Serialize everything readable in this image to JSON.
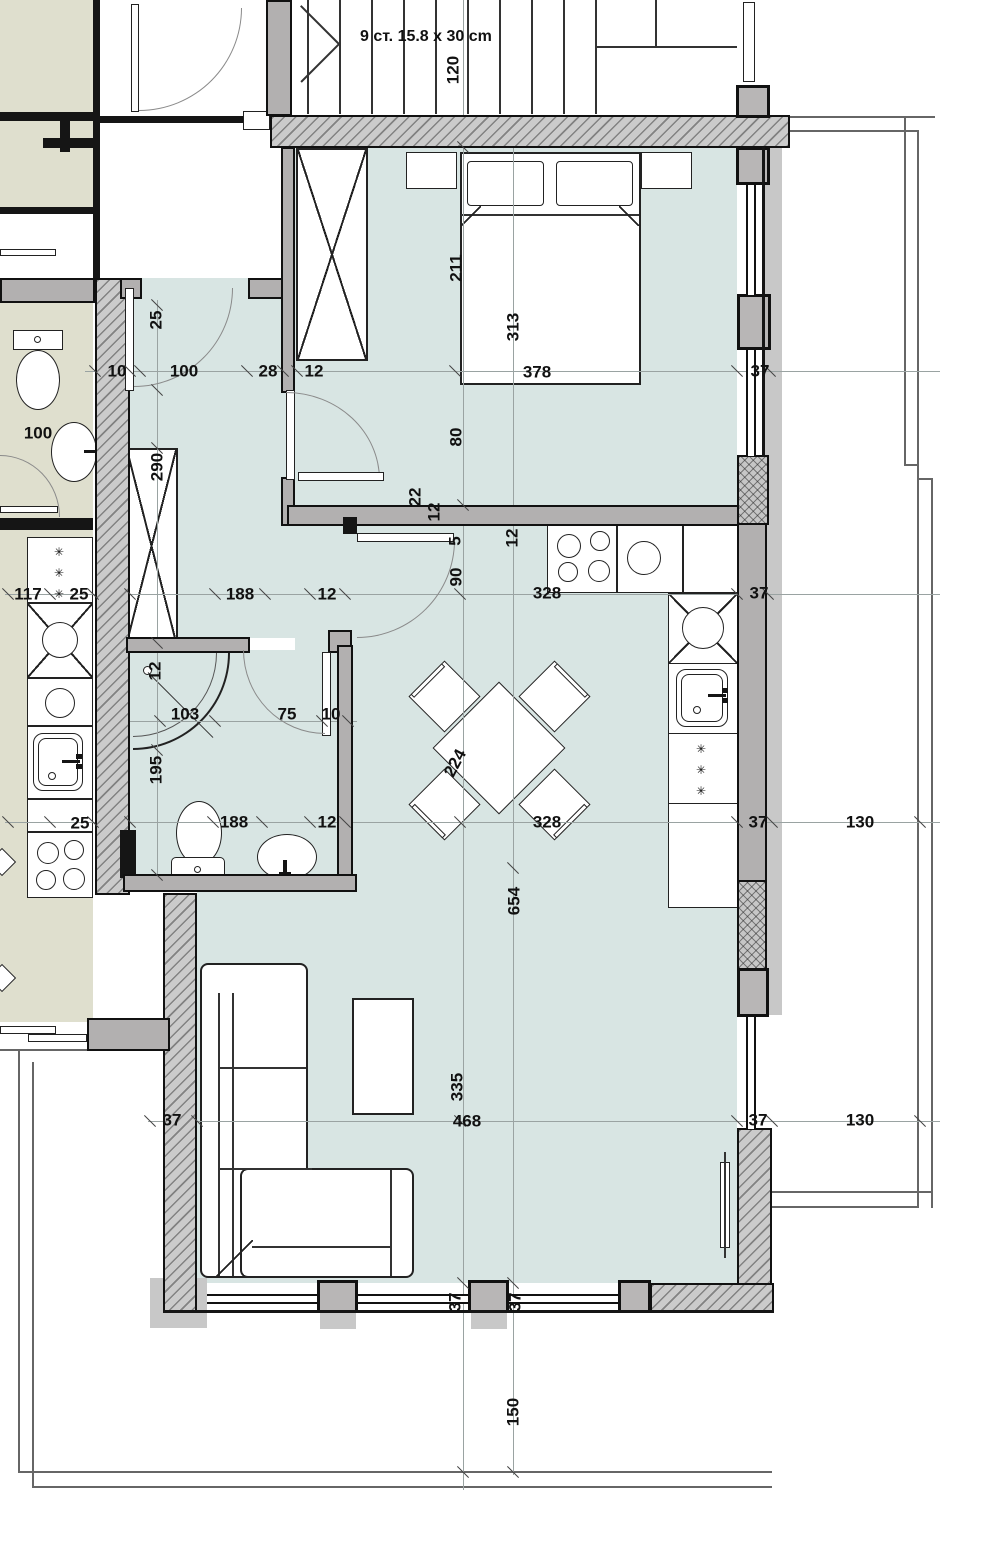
{
  "plan": {
    "stairs_label": "9 ст. 15.8 x 30 cm",
    "fridge_symbol": "✳✳✳"
  },
  "colors": {
    "apartment_floor": "#d8e5e3",
    "neighbor_floor": "#dfdfce",
    "wall_gray": "#b2b0b0",
    "hatch_wall": "#cbcbcb",
    "line_black": "#111111"
  },
  "dimensions": [
    {
      "t": "120",
      "x": 453,
      "y": 70,
      "r": -90
    },
    {
      "t": "25",
      "x": 156,
      "y": 320,
      "r": -90
    },
    {
      "t": "10",
      "x": 117,
      "y": 371,
      "r": 0
    },
    {
      "t": "100",
      "x": 184,
      "y": 371,
      "r": 0
    },
    {
      "t": "28",
      "x": 268,
      "y": 371,
      "r": 0
    },
    {
      "t": "12",
      "x": 314,
      "y": 371,
      "r": 0
    },
    {
      "t": "211",
      "x": 456,
      "y": 268,
      "r": -90
    },
    {
      "t": "313",
      "x": 513,
      "y": 327,
      "r": -90
    },
    {
      "t": "378",
      "x": 537,
      "y": 372,
      "r": 0
    },
    {
      "t": "37",
      "x": 760,
      "y": 371,
      "r": 0
    },
    {
      "t": "100",
      "x": 38,
      "y": 433,
      "r": 0
    },
    {
      "t": "290",
      "x": 157,
      "y": 467,
      "r": -90
    },
    {
      "t": "80",
      "x": 456,
      "y": 437,
      "r": -90
    },
    {
      "t": "22",
      "x": 415,
      "y": 497,
      "r": -90
    },
    {
      "t": "12",
      "x": 434,
      "y": 512,
      "r": -90
    },
    {
      "t": "5",
      "x": 455,
      "y": 541,
      "r": -90
    },
    {
      "t": "90",
      "x": 456,
      "y": 577,
      "r": -90
    },
    {
      "t": "12",
      "x": 512,
      "y": 538,
      "r": -90
    },
    {
      "t": "117",
      "x": 28,
      "y": 594,
      "r": 0
    },
    {
      "t": "25",
      "x": 79,
      "y": 594,
      "r": 0
    },
    {
      "t": "188",
      "x": 240,
      "y": 594,
      "r": 0
    },
    {
      "t": "12",
      "x": 327,
      "y": 594,
      "r": 0
    },
    {
      "t": "328",
      "x": 547,
      "y": 593,
      "r": 0
    },
    {
      "t": "37",
      "x": 759,
      "y": 593,
      "r": 0
    },
    {
      "t": "12",
      "x": 155,
      "y": 671,
      "r": -90
    },
    {
      "t": "103",
      "x": 185,
      "y": 714,
      "r": 0
    },
    {
      "t": "75",
      "x": 287,
      "y": 714,
      "r": 0
    },
    {
      "t": "10",
      "x": 331,
      "y": 714,
      "r": 0
    },
    {
      "t": "195",
      "x": 156,
      "y": 770,
      "r": -90
    },
    {
      "t": "224",
      "x": 455,
      "y": 763,
      "r": -62
    },
    {
      "t": "188",
      "x": 234,
      "y": 822,
      "r": 0
    },
    {
      "t": "12",
      "x": 327,
      "y": 822,
      "r": 0
    },
    {
      "t": "328",
      "x": 547,
      "y": 822,
      "r": 0
    },
    {
      "t": "37",
      "x": 758,
      "y": 822,
      "r": 0
    },
    {
      "t": "130",
      "x": 860,
      "y": 822,
      "r": 0
    },
    {
      "t": "25",
      "x": 80,
      "y": 823,
      "r": 0
    },
    {
      "t": "654",
      "x": 514,
      "y": 901,
      "r": -90
    },
    {
      "t": "37",
      "x": 172,
      "y": 1120,
      "r": 0
    },
    {
      "t": "335",
      "x": 457,
      "y": 1087,
      "r": -90
    },
    {
      "t": "468",
      "x": 467,
      "y": 1121,
      "r": 0
    },
    {
      "t": "37",
      "x": 758,
      "y": 1120,
      "r": 0
    },
    {
      "t": "130",
      "x": 860,
      "y": 1120,
      "r": 0
    },
    {
      "t": "37",
      "x": 455,
      "y": 1302,
      "r": -90
    },
    {
      "t": "37",
      "x": 515,
      "y": 1302,
      "r": -90
    },
    {
      "t": "150",
      "x": 513,
      "y": 1412,
      "r": -90
    }
  ]
}
